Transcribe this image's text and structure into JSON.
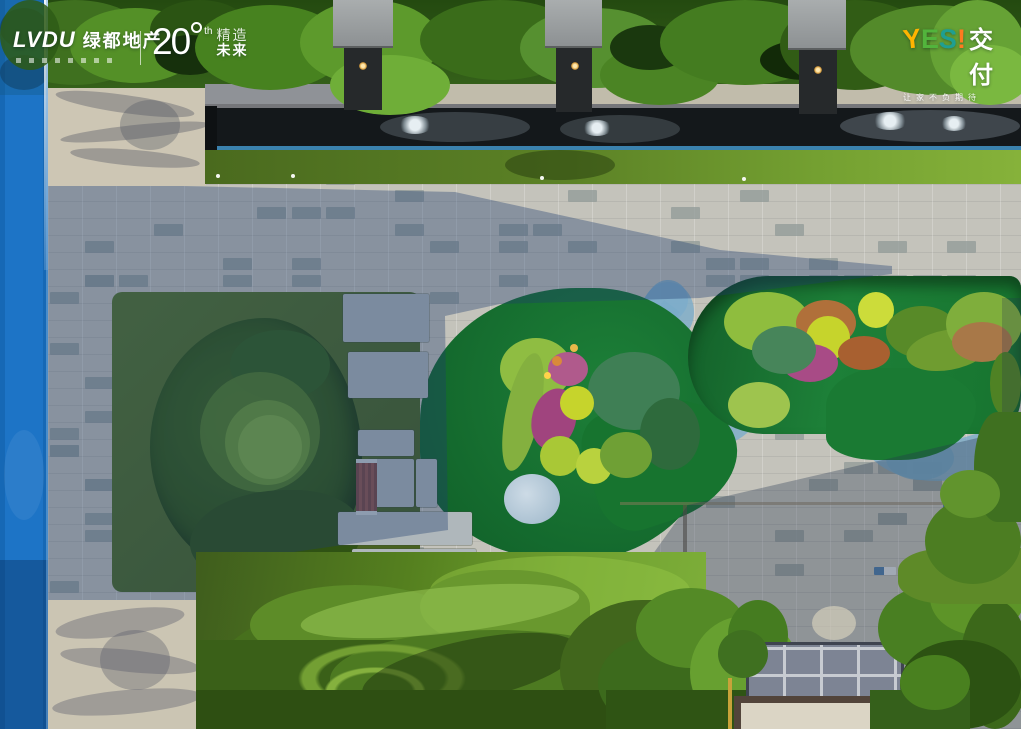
{
  "branding": {
    "lvdu": {
      "name": "LVDU",
      "cn_name": "绿都地产"
    },
    "anniversary": {
      "number": "20",
      "suffix": "th",
      "slogan_line1": "精造",
      "slogan_line2": "未来"
    },
    "yes_delivery": {
      "letters": [
        "Y",
        "E",
        "S",
        "!"
      ],
      "letter_colors": [
        "#ffb400",
        "#52b43c",
        "#1f9f92",
        "#ff7a1f"
      ],
      "cn": "交付",
      "tagline": "让家不负期待"
    }
  },
  "scene_colors": {
    "track_blue": "#1a6ec2",
    "stream_blue": "#7cadca",
    "lawn_green": "#18763a",
    "paving_grey": "#c4c3bb",
    "hedge_green": "#4a7420"
  }
}
